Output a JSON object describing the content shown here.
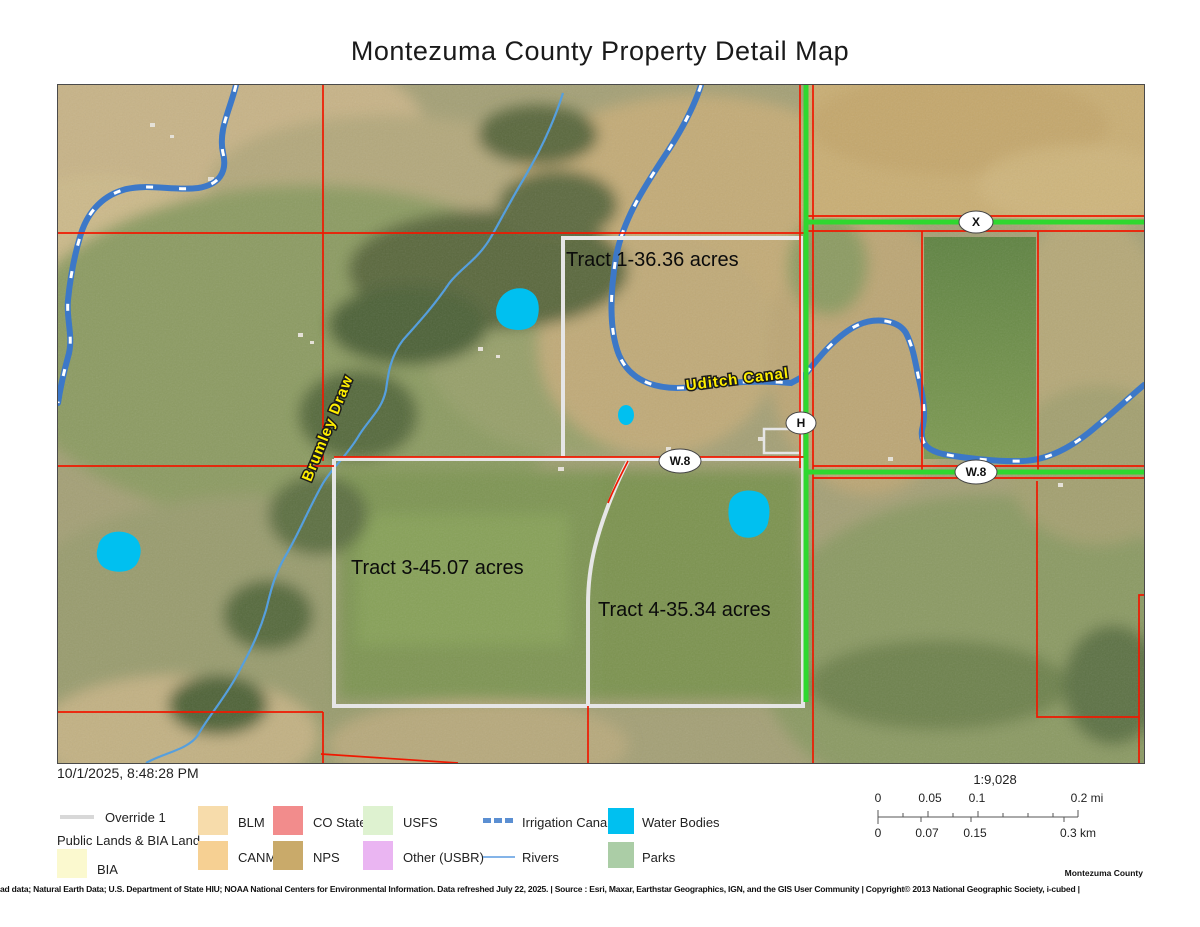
{
  "title": "Montezuma County Property Detail Map",
  "timestamp": "10/1/2025, 8:48:28 PM",
  "map": {
    "tract1_label": "Tract 1-36.36 acres",
    "tract3_label": "Tract 3-45.07 acres",
    "tract4_label": "Tract 4-35.34 acres",
    "canal_label": "Uditch Canal",
    "draw_label": "Brumley Draw",
    "road_marker_x": "X",
    "road_marker_h": "H",
    "road_marker_w8_left": "W.8",
    "road_marker_w8_right": "W.8",
    "colors": {
      "parcel_boundary": "#f01800",
      "highlighted_road": "#2fd82f",
      "override_road": "#e6e6e6",
      "canal": "#3c78c8",
      "river": "#569fdd",
      "water_body": "#00c0f0",
      "map_label_yellow": "#ffef00"
    }
  },
  "legend": {
    "override_label": "Override 1",
    "override_color": "#d8d8d8",
    "public_lands_header": "Public Lands & BIA Land",
    "bia": {
      "label": "BIA",
      "color": "#fbf9cf"
    },
    "blm": {
      "label": "BLM",
      "color": "#f7dcab"
    },
    "canm": {
      "label": "CANM",
      "color": "#f6d093"
    },
    "co_state": {
      "label": "CO State",
      "color": "#f28c8c"
    },
    "nps": {
      "label": "NPS",
      "color": "#c9aa6a"
    },
    "usfs": {
      "label": "USFS",
      "color": "#def2d0"
    },
    "other_usbr": {
      "label": "Other (USBR)",
      "color": "#eab5f2"
    },
    "irrigation_canals": {
      "label": "Irrigation Canals",
      "color": "#5b8fd2"
    },
    "rivers": {
      "label": "Rivers",
      "color": "#84b4e8"
    },
    "water_bodies": {
      "label": "Water Bodies",
      "color": "#00c0f0"
    },
    "parks": {
      "label": "Parks",
      "color": "#abcda6"
    }
  },
  "scale": {
    "ratio_label": "1:9,028",
    "miles": [
      "0",
      "0.05",
      "0.1",
      "0.2 mi"
    ],
    "kilometers": [
      "0",
      "0.07",
      "0.15",
      "0.3 km"
    ]
  },
  "attribution": {
    "county_credit": "Montezuma County",
    "credits": "ad data; Natural Earth Data; U.S. Department of State HIU; NOAA National Centers for Environmental Information. Data refreshed July 22, 2025. | Source : Esri, Maxar, Earthstar Geographics, IGN, and the GIS User Community | Copyright© 2013 National Geographic Society, i-cubed |"
  }
}
